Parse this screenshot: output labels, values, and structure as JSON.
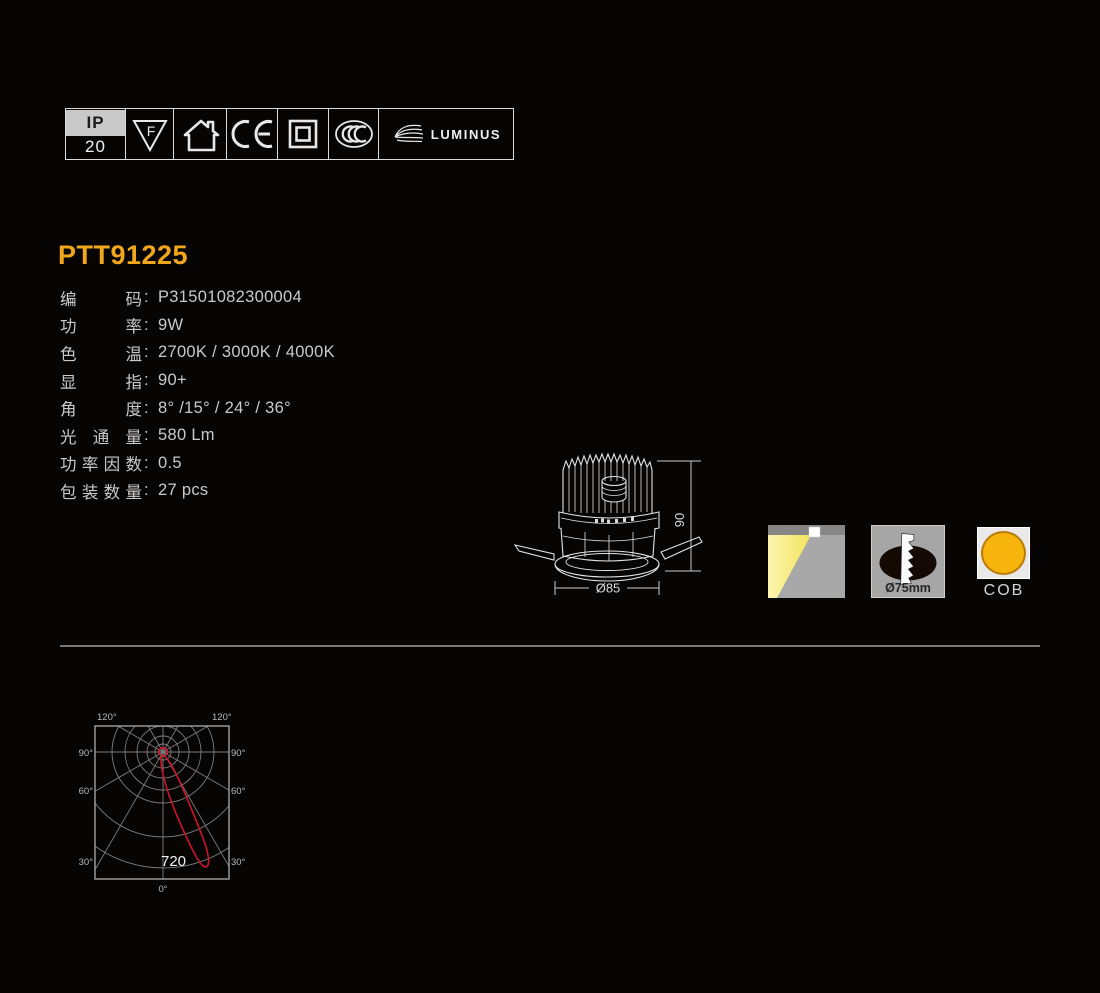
{
  "page": {
    "background": "#070404",
    "accent_color": "#F0A71C"
  },
  "cert_bar": {
    "ip_top": "IP",
    "ip_bottom": "20",
    "f_mark": "F",
    "luminus_label": "LUMINUS",
    "icons": [
      "ip-rating-badge",
      "f-triangle-icon",
      "recessed-house-icon",
      "ce-mark-icon",
      "class-ii-square-icon",
      "ccc-mark-icon",
      "luminus-logo"
    ]
  },
  "product": {
    "model": "PTT91225",
    "colon": ":",
    "specs": [
      {
        "label": "编码",
        "value": "P31501082300004"
      },
      {
        "label": "功率",
        "value": "9W"
      },
      {
        "label": "色温",
        "value": "2700K / 3000K / 4000K"
      },
      {
        "label": "显指",
        "value": "90+"
      },
      {
        "label": "角度",
        "value": "8° /15° / 24° / 36°"
      },
      {
        "label": "光通量",
        "value": "580 Lm"
      },
      {
        "label": "功率因数",
        "value": "0.5"
      },
      {
        "label": "包装数量",
        "value": "27 pcs"
      }
    ]
  },
  "drawing": {
    "height_dim": "90",
    "diameter_dim": "Ø85"
  },
  "feature_icons": {
    "beam_icon": "recessed-beam-icon",
    "cutout_label": "Ø75mm",
    "cob_label": "COB",
    "cob_color": "#F7B40D"
  },
  "chart_data": {
    "type": "polar",
    "description": "Luminous intensity distribution curve",
    "angle_tick_labels": [
      "0°",
      "30°",
      "60°",
      "90°",
      "120°"
    ],
    "peak_intensity": "720",
    "beam_tilt_deg": 21,
    "curve_color": "#CC1626",
    "grid": true
  },
  "chart_labels": {
    "a120": "120°",
    "a90": "90°",
    "a60": "60°",
    "a30": "30°",
    "a0": "0°",
    "peak": "720"
  }
}
